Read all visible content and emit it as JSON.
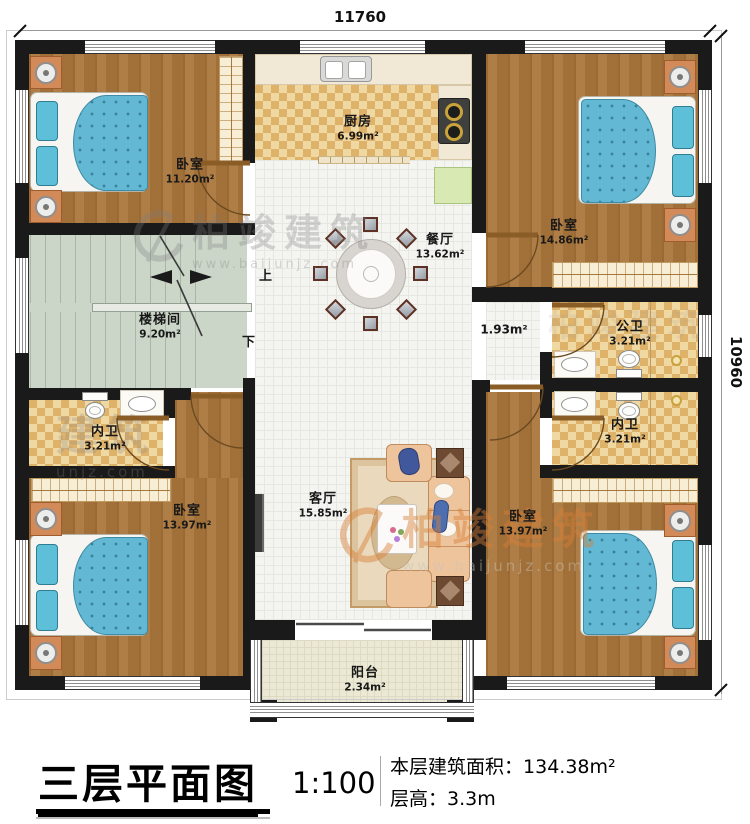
{
  "dimensions": {
    "top": "11760",
    "right": "10960"
  },
  "rooms": [
    {
      "id": "bedroom-top-left",
      "name": "卧室",
      "area": "11.20m²"
    },
    {
      "id": "kitchen",
      "name": "厨房",
      "area": "6.99m²"
    },
    {
      "id": "bedroom-top-right",
      "name": "卧室",
      "area": "14.86m²"
    },
    {
      "id": "dining-room",
      "name": "餐厅",
      "area": "13.62m²"
    },
    {
      "id": "stairwell",
      "name": "楼梯间",
      "area": "9.20m²"
    },
    {
      "id": "bath-inner-left",
      "name": "内卫",
      "area": "3.21m²"
    },
    {
      "id": "bath-public",
      "name": "公卫",
      "area": "3.21m²"
    },
    {
      "id": "bath-inner-right",
      "name": "内卫",
      "area": "3.21m²"
    },
    {
      "id": "hallway",
      "name": "",
      "area": "1.93m²"
    },
    {
      "id": "living-room",
      "name": "客厅",
      "area": "15.85m²"
    },
    {
      "id": "bedroom-bottom-left",
      "name": "卧室",
      "area": "13.97m²"
    },
    {
      "id": "bedroom-bottom-right",
      "name": "卧室",
      "area": "13.97m²"
    },
    {
      "id": "balcony",
      "name": "阳台",
      "area": "2.34m²"
    }
  ],
  "stairs": {
    "up": "上",
    "down": "下"
  },
  "caption": {
    "title": "三层平面图",
    "scale": "1:100",
    "area_label": "本层建筑面积：",
    "area_value": "134.38m²",
    "height_label": "层高：",
    "height_value": "3.3m"
  },
  "watermark": {
    "brand": "柏竣建筑",
    "url": "www.baijunjz.com",
    "partial_brand": "建筑",
    "partial_url": "unjz.com"
  },
  "colors": {
    "wall": "#1a1a1a",
    "wood": "#aa763c",
    "tile_bath": "#dfb269",
    "bed": "#63b8d3",
    "accent_watermark": "#d97f35"
  }
}
